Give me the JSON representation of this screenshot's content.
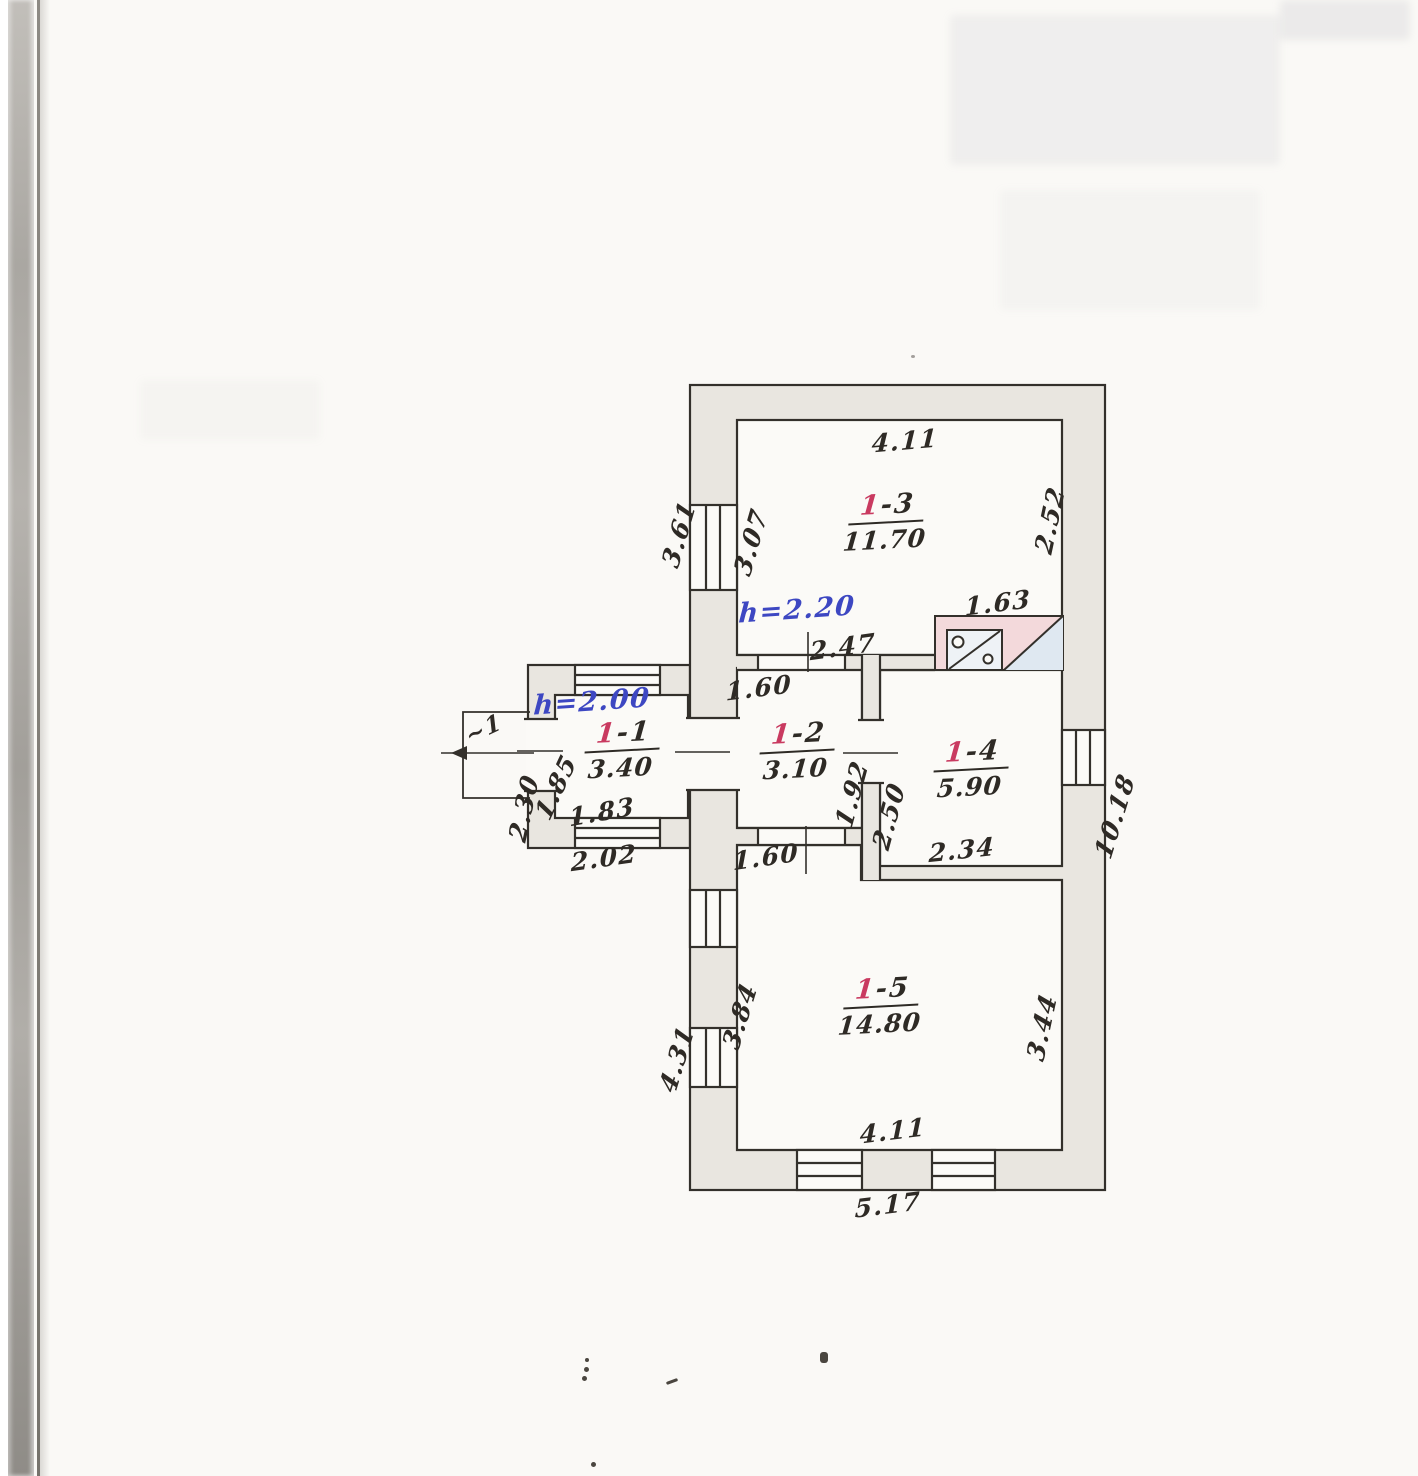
{
  "document": {
    "kind": "scanned hand-drawn floor plan"
  },
  "plan": {
    "rooms": [
      {
        "prefix": "1",
        "suffix": "-1",
        "area": "3.40"
      },
      {
        "prefix": "1",
        "suffix": "-2",
        "area": "3.10"
      },
      {
        "prefix": "1",
        "suffix": "-3",
        "area": "11.70"
      },
      {
        "prefix": "1",
        "suffix": "-4",
        "area": "5.90"
      },
      {
        "prefix": "1",
        "suffix": "-5",
        "area": "14.80"
      }
    ],
    "heights": {
      "main": "h=2.20",
      "annex": "h=2.00"
    },
    "dims": {
      "top_width": "4.11",
      "right_13": "2.52",
      "left_outer_13": "3.61",
      "left_inner_13": "3.07",
      "stove_width": "1.63",
      "mid_partition": "2.47",
      "door_12_top": "1.60",
      "door_12_bottom": "1.60",
      "right_12": "1.92",
      "left_14": "2.50",
      "bottom_14": "2.34",
      "right_outer": "10.18",
      "porch": "~1",
      "annex_left_outer": "2.30",
      "annex_left_inner": "1.85",
      "annex_bottom_inner": "1.83",
      "annex_bottom_outer": "2.02",
      "left_inner_15": "3.84",
      "left_outer_15": "4.31",
      "right_15": "3.44",
      "bottom_inner_15": "4.11",
      "bottom_outer": "5.17"
    },
    "colors": {
      "ink": "#2e2a25",
      "ink_red": "#c93a60",
      "ink_blue": "#3d47c2",
      "wall_fill": "#e9e6e0",
      "stove_pink": "#f3d9db",
      "stove_blue": "#dfe8f1"
    }
  }
}
